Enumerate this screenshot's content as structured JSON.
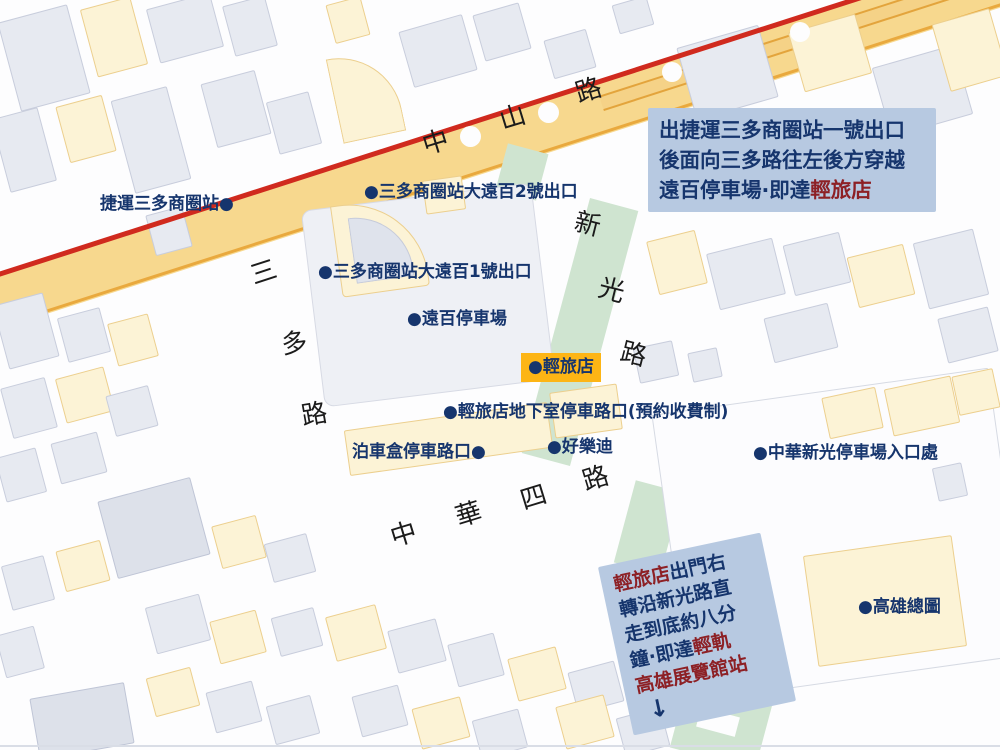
{
  "map_title": "輕旅店周邊地圖",
  "colors": {
    "label_navy": "#16356d",
    "accent_red": "#8d2025",
    "note_bg": "#b7c9e1",
    "road_yellow": "#f7d88e",
    "rail_red": "#d02a1e",
    "green_strip": "#cfe4d0",
    "hotel_badge_bg": "#fdb515"
  },
  "streets": {
    "zhongshan_road": [
      "中",
      "山",
      "路"
    ],
    "sanduo_road": [
      "三",
      "多",
      "路"
    ],
    "xinguang_road": [
      "新",
      "光",
      "路"
    ],
    "zhonghua_4th_road": [
      "中",
      "華",
      "四",
      "路"
    ]
  },
  "markers": [
    {
      "id": "mrt-sanduo-station",
      "label": "捷運三多商圈站●"
    },
    {
      "id": "sanduo-exit-2",
      "label": "●三多商圈站大遠百2號出口"
    },
    {
      "id": "sanduo-exit-1",
      "label": "●三多商圈站大遠百1號出口"
    },
    {
      "id": "fe-department-parking",
      "label": "●遠百停車場"
    },
    {
      "id": "hotel-basement-parking",
      "label": "●輕旅店地下室停車路口(預約收費制)"
    },
    {
      "id": "parking-box-entrance",
      "label": "泊車盒停車路口●"
    },
    {
      "id": "holiday-ktv",
      "label": "●好樂迪"
    },
    {
      "id": "zhonghua-xinguang-parking-entrance",
      "label": "●中華新光停車場入口處"
    },
    {
      "id": "kaohsiung-main-library",
      "label": "●高雄總圖"
    }
  ],
  "hotel_badge": {
    "label": "●輕旅店"
  },
  "note_top": {
    "line1": "出捷運三多商圈站一號出口",
    "line2": "後面向三多路往左後方穿越",
    "line3_prefix": "遠百停車場·即達",
    "line3_highlight": "輕旅店"
  },
  "note_bottom": {
    "line1_highlight": "輕旅店",
    "line1_rest": "出門右",
    "line2": "轉沿新光路直",
    "line3": "走到底約八分",
    "line4_prefix": "鐘·即達",
    "line4_highlight": "輕軌",
    "line5_highlight": "高雄展覽館站",
    "arrow": "↓"
  }
}
